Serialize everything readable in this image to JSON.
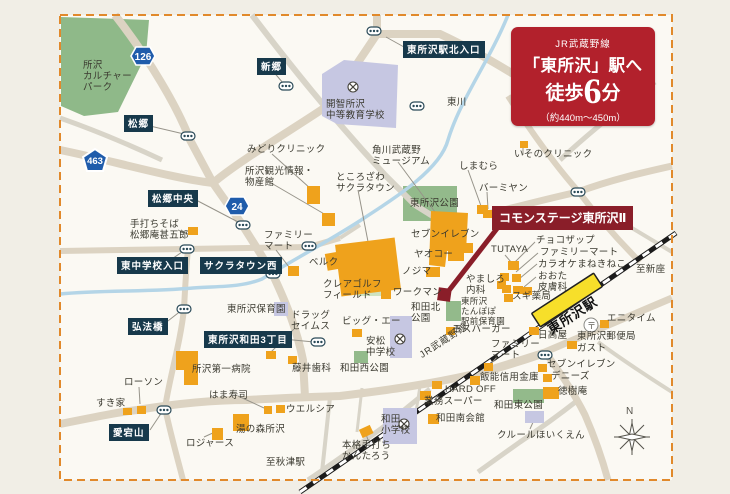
{
  "banner": {
    "line_small": "JR武蔵野線",
    "station_to": "「東所沢」駅へ",
    "walk_prefix": "徒歩",
    "walk_minutes": "6",
    "walk_suffix": "分",
    "distance": "（約440m〜450m）"
  },
  "property": {
    "label": "コモンステージ東所沢Ⅱ"
  },
  "station": {
    "label": "東所沢駅"
  },
  "railway": {
    "line_label": "JR武蔵野線",
    "dir_ne": "至新座",
    "dir_sw": "至秋津駅"
  },
  "compass": {
    "north": "N"
  },
  "postal_mark": "〒",
  "shields": {
    "r463": "463",
    "r126": "126",
    "r24": "24"
  },
  "intersections": [
    "松郷",
    "新郷",
    "東所沢駅北入口",
    "松郷中央",
    "東中学校入口",
    "サクラタウン西",
    "弘法橋",
    "東所沢和田3丁目",
    "愛宕山"
  ],
  "places": [
    "所沢\nカルチャー\nパーク",
    "開智所沢\n中等教育学校",
    "東川",
    "みどりクリニック",
    "所沢観光情報・\n物産館",
    "角川武蔵野\nミュージアム",
    "ところざわ\nサクラタウン",
    "しまむら",
    "いそのクリニック",
    "バーミヤン",
    "東所沢公園",
    "セブンイレブン",
    "ヤオコー",
    "ノジマ",
    "ワークマン",
    "クレアゴルフ\nフィールド",
    "ファミリー\nマート",
    "ベルク",
    "手打ちそば\n松郷庵甚五郎",
    "東所沢保育園",
    "ドラッグ\nセイムス",
    "ビッグ・エー",
    "安松\n中学校",
    "和田西公園",
    "藤井歯科",
    "所沢第一病院",
    "はま寿司",
    "ウエルシア",
    "湯の森所沢",
    "ロジャース",
    "すき家",
    "ローソン",
    "和田北\n公園",
    "東所沢\nたんぽぽ\n駅前保育園",
    "やましろ\n内科",
    "モスバーガー",
    "スギ薬局",
    "TUTAYA",
    "チョコザップ",
    "ファミリーマート",
    "カラオケまねきねこ",
    "おおた\n皮膚科",
    "日高屋",
    "東所沢郵便局",
    "エニタイム",
    "ガスト",
    "ファミリー\nマート",
    "セブンイレブン",
    "デニーズ",
    "徳樹庵",
    "飯能信用金庫",
    "HARD OFF",
    "業務スーパー",
    "和田南会館",
    "和田\n小学校",
    "和田東公園",
    "クルールほいくえん",
    "本格手打ち\nかんたろう",
    "至秋津駅",
    "至新座"
  ]
}
